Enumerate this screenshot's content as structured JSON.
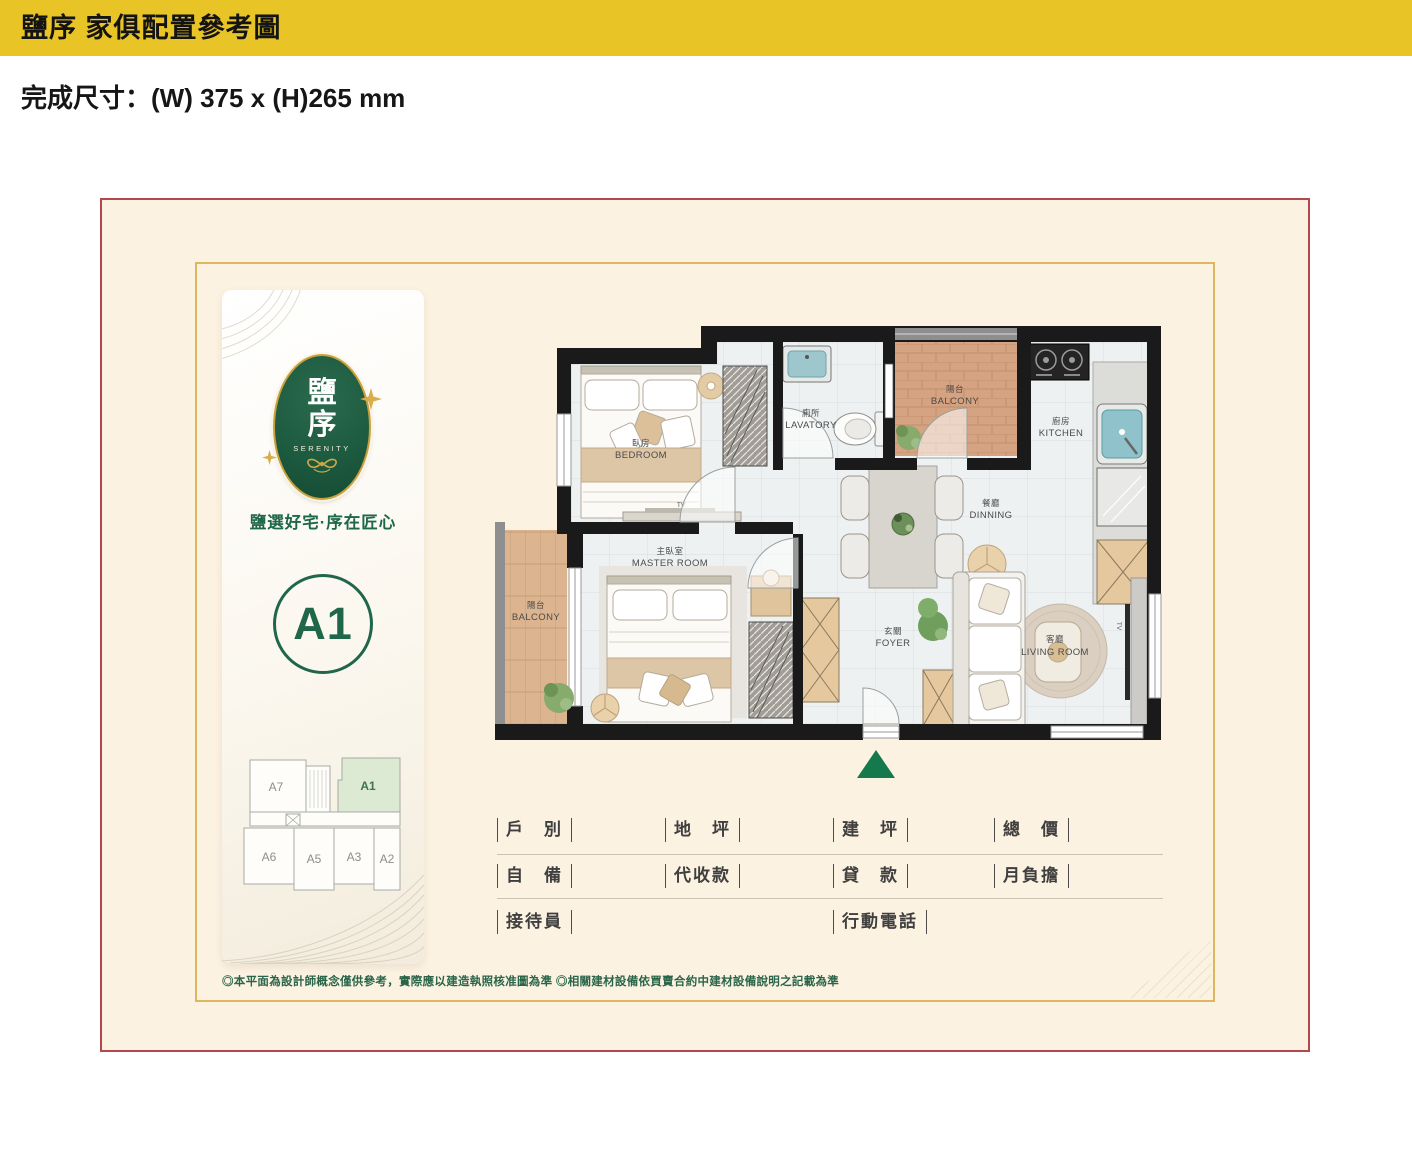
{
  "header": {
    "title": "鹽序 家俱配置參考圖"
  },
  "spec_line": "完成尺寸：(W) 375 x (H)265 mm",
  "brand": {
    "logo_char_1": "鹽",
    "logo_char_2": "序",
    "logo_en": "SERENITY",
    "tagline": "鹽選好宅·序在匠心",
    "unit_label": "A1"
  },
  "floorplate": {
    "units": [
      "A7",
      "A1",
      "A6",
      "A5",
      "A3",
      "A2"
    ]
  },
  "plan": {
    "rooms": {
      "bedroom": {
        "zh": "臥房",
        "en": "BEDROOM"
      },
      "lavatory": {
        "zh": "廁所",
        "en": "LAVATORY"
      },
      "balcony_top": {
        "zh": "陽台",
        "en": "BALCONY"
      },
      "kitchen": {
        "zh": "廚房",
        "en": "KITCHEN"
      },
      "dining": {
        "zh": "餐廳",
        "en": "DINNING"
      },
      "master": {
        "zh": "主臥室",
        "en": "MASTER ROOM"
      },
      "balcony_left": {
        "zh": "陽台",
        "en": "BALCONY"
      },
      "foyer": {
        "zh": "玄關",
        "en": "FOYER"
      },
      "living": {
        "zh": "客廳",
        "en": "LIVING ROOM"
      }
    },
    "tv_label": "TV"
  },
  "form": {
    "row1": [
      "戶　別",
      "地　坪",
      "建　坪",
      "總　價"
    ],
    "row2": [
      "自　備",
      "代收款",
      "貸　款",
      "月負擔"
    ],
    "row3": [
      "接待員",
      "行動電話"
    ]
  },
  "disclaimer": "◎本平面為設計師概念僅供參考，實際應以建造執照核准圖為準 ◎相關建材設備依買賣合約中建材設備說明之記載為準",
  "colors": {
    "header_yellow": "#e9c427",
    "frame_red": "#b4494d",
    "frame_gold": "#dfb660",
    "brand_green": "#1d5b40",
    "gold": "#c9a03c",
    "entry_green": "#15794e"
  }
}
